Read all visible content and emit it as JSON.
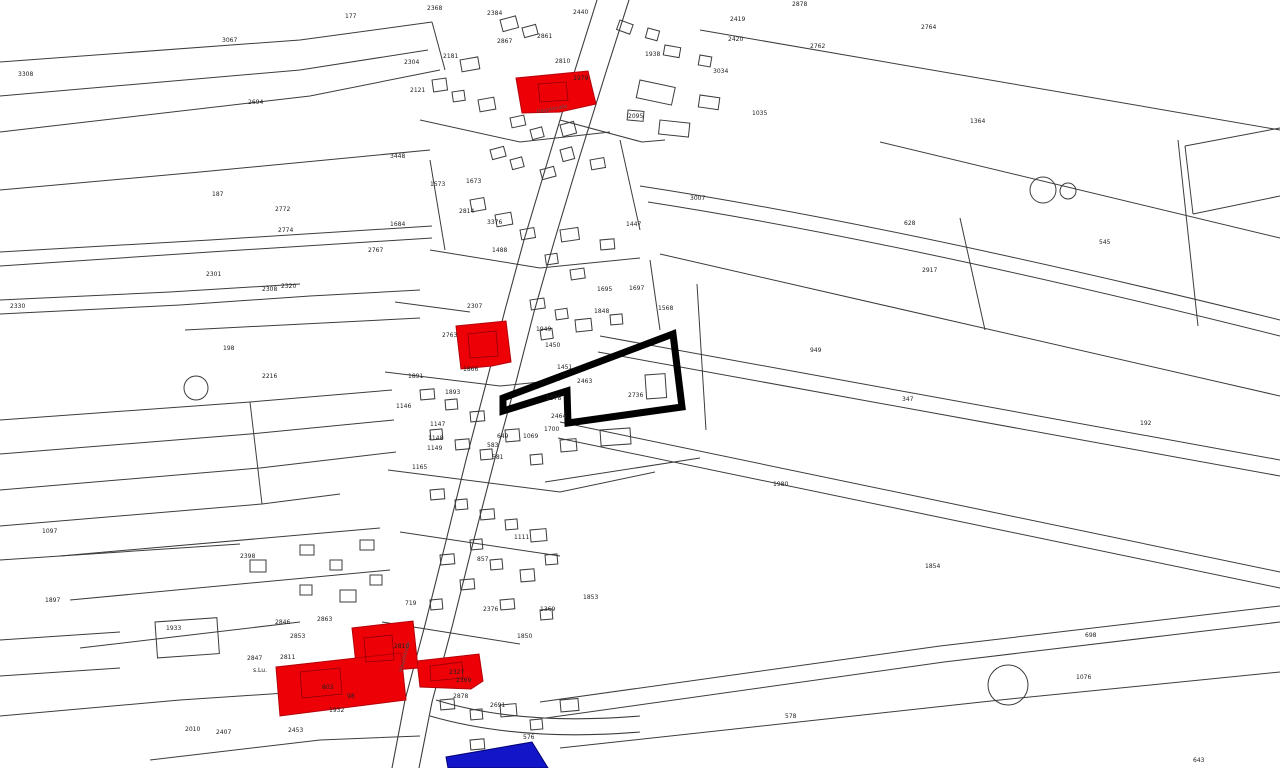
{
  "map": {
    "colors": {
      "background": "#ffffff",
      "parcel_line": "#3c3c3c",
      "highlight_red": "#ee0007",
      "highlight_blue": "#1316c8",
      "selection_outline": "#000000"
    },
    "street_labels": [
      {
        "text": "Hauptstraße",
        "x": 402,
        "y": 672,
        "angle": -75
      },
      {
        "text": "Hauptstraße",
        "x": 537,
        "y": 113,
        "angle": -10
      }
    ],
    "labels": [
      [
        "3308",
        18,
        76
      ],
      [
        "3067",
        222,
        42
      ],
      [
        "177",
        345,
        18
      ],
      [
        "2694",
        248,
        104
      ],
      [
        "2368",
        427,
        10
      ],
      [
        "2384",
        487,
        15
      ],
      [
        "2440",
        573,
        14
      ],
      [
        "2867",
        497,
        43
      ],
      [
        "2861",
        537,
        38
      ],
      [
        "2181",
        443,
        58
      ],
      [
        "2304",
        404,
        64
      ],
      [
        "2121",
        410,
        92
      ],
      [
        "2095",
        628,
        118
      ],
      [
        "1938",
        645,
        56
      ],
      [
        "2810",
        555,
        63
      ],
      [
        "1979",
        573,
        80
      ],
      [
        "2419",
        730,
        21
      ],
      [
        "2420",
        728,
        41
      ],
      [
        "2762",
        810,
        48
      ],
      [
        "2878",
        792,
        6
      ],
      [
        "2764",
        921,
        29
      ],
      [
        "3034",
        713,
        73
      ],
      [
        "1035",
        752,
        115
      ],
      [
        "1364",
        970,
        123
      ],
      [
        "3007",
        690,
        200
      ],
      [
        "2917",
        922,
        272
      ],
      [
        "628",
        904,
        225
      ],
      [
        "545",
        1099,
        244
      ],
      [
        "3448",
        390,
        158
      ],
      [
        "187",
        212,
        196
      ],
      [
        "2772",
        275,
        211
      ],
      [
        "2774",
        278,
        232
      ],
      [
        "1684",
        390,
        226
      ],
      [
        "2767",
        368,
        252
      ],
      [
        "1573",
        430,
        186
      ],
      [
        "1673",
        466,
        183
      ],
      [
        "2814",
        459,
        213
      ],
      [
        "3376",
        487,
        224
      ],
      [
        "1447",
        626,
        226
      ],
      [
        "1488",
        492,
        252
      ],
      [
        "2301",
        206,
        276
      ],
      [
        "2308",
        262,
        291
      ],
      [
        "2320",
        281,
        288
      ],
      [
        "2330",
        10,
        308
      ],
      [
        "198",
        223,
        350
      ],
      [
        "2216",
        262,
        378
      ],
      [
        "1695",
        597,
        291
      ],
      [
        "1697",
        629,
        290
      ],
      [
        "1848",
        594,
        313
      ],
      [
        "1568",
        658,
        310
      ],
      [
        "2763",
        442,
        337
      ],
      [
        "2307",
        467,
        308
      ],
      [
        "1949",
        536,
        331
      ],
      [
        "1450",
        545,
        347
      ],
      [
        "1451",
        557,
        369
      ],
      [
        "2463",
        577,
        383
      ],
      [
        "2736",
        628,
        397
      ],
      [
        "1866",
        463,
        371
      ],
      [
        "1891",
        408,
        378
      ],
      [
        "1893",
        445,
        394
      ],
      [
        "1146",
        396,
        408
      ],
      [
        "1147",
        430,
        426
      ],
      [
        "1148",
        428,
        440
      ],
      [
        "1149",
        427,
        450
      ],
      [
        "1165",
        412,
        469
      ],
      [
        "1069",
        523,
        438
      ],
      [
        "649",
        497,
        438
      ],
      [
        "583",
        487,
        447
      ],
      [
        "581",
        492,
        459
      ],
      [
        "1578",
        546,
        400
      ],
      [
        "2464",
        551,
        418
      ],
      [
        "1700",
        544,
        431
      ],
      [
        "949",
        810,
        352
      ],
      [
        "347",
        902,
        401
      ],
      [
        "192",
        1140,
        425
      ],
      [
        "1980",
        773,
        486
      ],
      [
        "1854",
        925,
        568
      ],
      [
        "1097",
        42,
        533
      ],
      [
        "1897",
        45,
        602
      ],
      [
        "2398",
        240,
        558
      ],
      [
        "1933",
        166,
        630
      ],
      [
        "1111",
        514,
        539
      ],
      [
        "857",
        477,
        561
      ],
      [
        "1853",
        583,
        599
      ],
      [
        "1369",
        540,
        611
      ],
      [
        "2376",
        483,
        611
      ],
      [
        "719",
        405,
        605
      ],
      [
        "1850",
        517,
        638
      ],
      [
        "2846",
        275,
        624
      ],
      [
        "2863",
        317,
        621
      ],
      [
        "2853",
        290,
        638
      ],
      [
        "2811",
        280,
        659
      ],
      [
        "2847",
        247,
        660
      ],
      [
        "s.Lu.",
        253,
        672
      ],
      [
        "2810",
        394,
        648
      ],
      [
        "1932",
        329,
        712
      ],
      [
        "803",
        322,
        689
      ],
      [
        "98",
        347,
        698
      ],
      [
        "2327",
        449,
        674
      ],
      [
        "2369",
        456,
        682
      ],
      [
        "2878",
        453,
        698
      ],
      [
        "2691",
        490,
        707
      ],
      [
        "2453",
        288,
        732
      ],
      [
        "2010",
        185,
        731
      ],
      [
        "2407",
        216,
        734
      ],
      [
        "576",
        523,
        739
      ],
      [
        "578",
        785,
        718
      ],
      [
        "698",
        1085,
        637
      ],
      [
        "1076",
        1076,
        679
      ],
      [
        "643",
        1193,
        762
      ]
    ],
    "strips": [
      "M0,62 L300,40 L432,22",
      "M0,96 L300,70 L428,50",
      "M0,132 L310,96 L440,70",
      "M432,22 L445,70",
      "M0,190 L200,172 L430,150",
      "M0,252 L210,240 L432,226",
      "M0,266 L210,252 L432,238",
      "M0,300 L170,292 L300,284",
      "M0,314 L180,305 L310,296 L420,290",
      "M185,330 L420,318",
      "M0,420 L250,402 L392,390",
      "M0,454 L250,434 L394,420",
      "M0,490 L260,468 L396,452",
      "M0,526 L262,504 L340,494",
      "M0,560 L240,544",
      "M0,640 L120,632",
      "M0,676 L120,668",
      "M60,556 L380,528",
      "M70,600 L390,570",
      "M80,648 L300,622",
      "M0,716 L180,700 L300,692",
      "M150,760 L320,740 L420,736",
      "M640,186 Q900,226 1280,320",
      "M648,202 Q905,242 1280,336",
      "M660,254 L1280,396",
      "M600,336 L1280,460",
      "M598,352 L1280,476",
      "M560,422 L1280,572",
      "M558,438 L1280,588",
      "M540,702 L940,646 L1280,606",
      "M546,718 L944,662 L1280,622",
      "M560,748 L1000,700 L1280,672",
      "M700,30 L1280,130",
      "M880,142 L1280,238",
      "M1178,140 L1198,326",
      "M960,218 L985,330",
      "M1185,146 L1280,128",
      "M1193,214 L1280,196",
      "M1185,146 L1193,214",
      "M420,120 L520,142 L610,132",
      "M430,250 L540,268 L640,258",
      "M395,302 L470,312",
      "M385,372 L500,386 L560,380",
      "M388,470 L560,492 L655,472",
      "M400,532 L560,556",
      "M382,622 L520,644",
      "M545,482 L700,458",
      "M430,160 L445,250",
      "M620,140 L640,230",
      "M650,260 L660,330",
      "M697,284 L706,430",
      "M250,402 L262,504"
    ],
    "buildings": [
      [
        500,
        20,
        16,
        12,
        -15
      ],
      [
        522,
        28,
        14,
        10,
        -15
      ],
      [
        460,
        60,
        18,
        12,
        -10
      ],
      [
        432,
        80,
        14,
        12,
        -8
      ],
      [
        452,
        92,
        12,
        10,
        -8
      ],
      [
        478,
        100,
        16,
        12,
        -10
      ],
      [
        510,
        118,
        14,
        10,
        -12
      ],
      [
        530,
        130,
        12,
        10,
        -15
      ],
      [
        560,
        125,
        14,
        12,
        -15
      ],
      [
        620,
        20,
        14,
        10,
        20
      ],
      [
        648,
        28,
        12,
        10,
        15
      ],
      [
        665,
        45,
        16,
        10,
        10
      ],
      [
        700,
        55,
        12,
        10,
        10
      ],
      [
        640,
        80,
        36,
        18,
        12
      ],
      [
        700,
        95,
        20,
        12,
        8
      ],
      [
        628,
        110,
        16,
        10,
        5
      ],
      [
        660,
        120,
        30,
        14,
        6
      ],
      [
        490,
        150,
        14,
        10,
        -15
      ],
      [
        510,
        160,
        12,
        10,
        -15
      ],
      [
        540,
        170,
        14,
        10,
        -15
      ],
      [
        560,
        150,
        12,
        12,
        -15
      ],
      [
        590,
        160,
        14,
        10,
        -10
      ],
      [
        470,
        200,
        14,
        12,
        -10
      ],
      [
        495,
        215,
        16,
        12,
        -10
      ],
      [
        520,
        230,
        14,
        10,
        -10
      ],
      [
        560,
        230,
        18,
        12,
        -8
      ],
      [
        600,
        240,
        14,
        10,
        -5
      ],
      [
        545,
        255,
        12,
        10,
        -8
      ],
      [
        570,
        270,
        14,
        10,
        -8
      ],
      [
        530,
        300,
        14,
        10,
        -8
      ],
      [
        555,
        310,
        12,
        10,
        -8
      ],
      [
        575,
        320,
        16,
        12,
        -6
      ],
      [
        610,
        315,
        12,
        10,
        -5
      ],
      [
        540,
        330,
        12,
        10,
        -8
      ],
      [
        420,
        390,
        14,
        10,
        -5
      ],
      [
        445,
        400,
        12,
        10,
        -5
      ],
      [
        470,
        412,
        14,
        10,
        -5
      ],
      [
        430,
        430,
        12,
        10,
        -5
      ],
      [
        455,
        440,
        14,
        10,
        -5
      ],
      [
        480,
        450,
        12,
        10,
        -5
      ],
      [
        505,
        430,
        14,
        12,
        -5
      ],
      [
        530,
        455,
        12,
        10,
        -5
      ],
      [
        560,
        440,
        16,
        12,
        -5
      ],
      [
        600,
        430,
        30,
        16,
        -4
      ],
      [
        645,
        375,
        20,
        24,
        -4
      ],
      [
        430,
        490,
        14,
        10,
        -5
      ],
      [
        455,
        500,
        12,
        10,
        -5
      ],
      [
        480,
        510,
        14,
        10,
        -5
      ],
      [
        505,
        520,
        12,
        10,
        -5
      ],
      [
        530,
        530,
        16,
        12,
        -5
      ],
      [
        470,
        540,
        12,
        10,
        -5
      ],
      [
        440,
        555,
        14,
        10,
        -5
      ],
      [
        490,
        560,
        12,
        10,
        -5
      ],
      [
        520,
        570,
        14,
        12,
        -5
      ],
      [
        545,
        555,
        12,
        10,
        -5
      ],
      [
        460,
        580,
        14,
        10,
        -5
      ],
      [
        430,
        600,
        12,
        10,
        -5
      ],
      [
        500,
        600,
        14,
        10,
        -5
      ],
      [
        540,
        610,
        12,
        10,
        -5
      ],
      [
        440,
        700,
        14,
        10,
        -5
      ],
      [
        470,
        710,
        12,
        10,
        -5
      ],
      [
        500,
        705,
        16,
        12,
        -5
      ],
      [
        530,
        720,
        12,
        10,
        -5
      ],
      [
        470,
        740,
        14,
        10,
        -5
      ],
      [
        520,
        745,
        12,
        10,
        -5
      ],
      [
        560,
        700,
        18,
        12,
        -5
      ],
      [
        250,
        560,
        16,
        12,
        0
      ],
      [
        300,
        545,
        14,
        10,
        0
      ],
      [
        330,
        560,
        12,
        10,
        0
      ],
      [
        360,
        540,
        14,
        10,
        0
      ],
      [
        300,
        585,
        12,
        10,
        0
      ],
      [
        340,
        590,
        16,
        12,
        0
      ],
      [
        370,
        575,
        12,
        10,
        0
      ],
      [
        155,
        622,
        62,
        36,
        -4
      ]
    ],
    "roads": [
      "M597,0 L575,70 L548,160 L524,240 L505,310 L487,380 L466,460 L445,545 L425,625 L405,700 L392,768",
      "M629,0 L606,72 L578,162 L554,242 L534,312 L516,382 L494,462 L472,547 L452,627 L432,702 L419,768",
      "M436,700 Q520,726 640,716",
      "M430,716 Q520,742 640,732",
      "M560,120 L642,142 L665,140"
    ],
    "red_parcels": [
      "M516,78 L588,71 L596,104 L560,112 L522,113 Z",
      "M456,326 L506,321 L511,362 L492,366 L461,369 Z",
      "M352,628 L413,621 L418,668 L357,673 Z",
      "M276,667 L401,653 L406,700 L280,716 Z",
      "M417,661 L479,654 L483,681 L471,689 L420,687 Z"
    ],
    "red_inner": [
      "M538,84 L566,82 L568,100 L540,102 Z",
      "M468,334 L496,331 L498,356 L470,358 Z",
      "M364,638 L392,635 L394,660 L366,662 Z",
      "M300,672 L340,668 L342,694 L302,698 Z",
      "M430,666 L462,662 L463,678 L431,681 Z"
    ],
    "blue_parcels": [
      "M446,757 L532,742 L548,768 L448,768 Z"
    ],
    "selection": "M503,398 L673,334 L682,407 L568,423 L567,391 L503,411 Z",
    "circles": [
      [
        1043,
        190,
        13
      ],
      [
        1068,
        191,
        8
      ],
      [
        196,
        388,
        12
      ],
      [
        1008,
        685,
        20
      ]
    ]
  }
}
